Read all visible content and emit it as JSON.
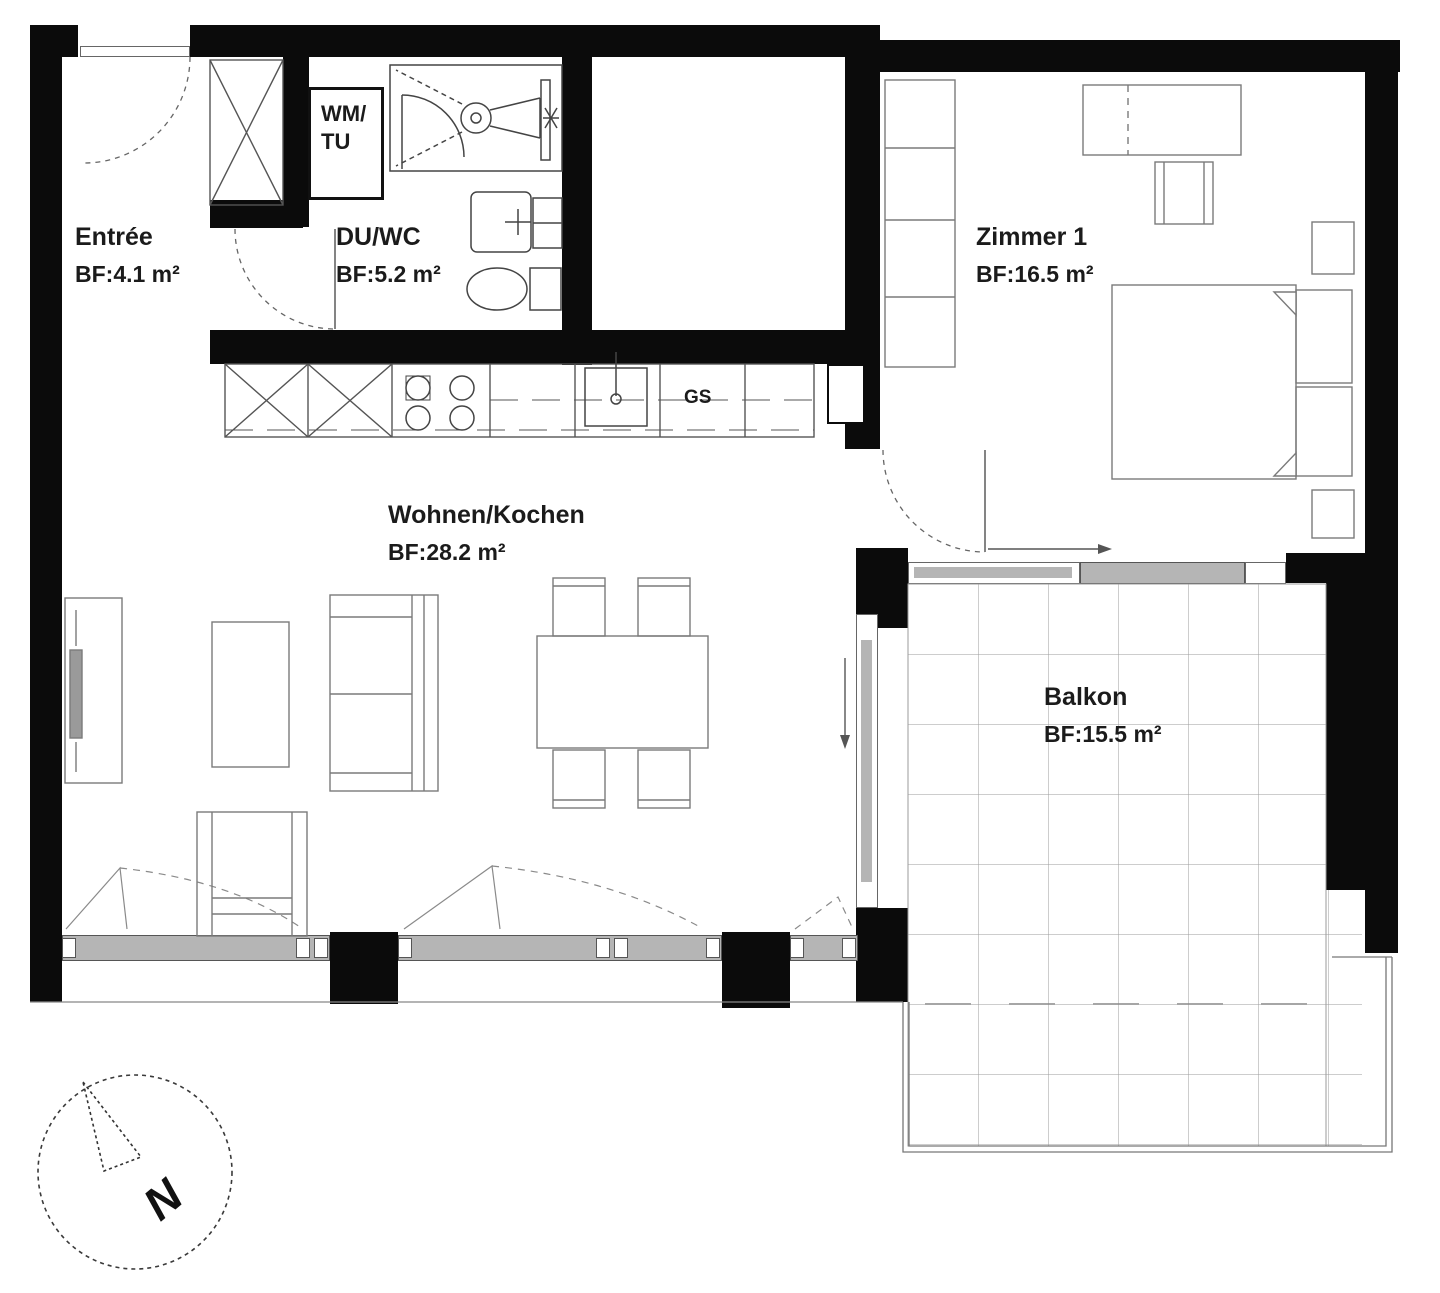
{
  "plan": {
    "rooms": {
      "entree": {
        "name": "Entrée",
        "area": "BF:4.1 m²"
      },
      "du_wc": {
        "name": "DU/WC",
        "area": "BF:5.2 m²"
      },
      "zimmer_1": {
        "name": "Zimmer 1",
        "area": "BF:16.5 m²"
      },
      "wohnen_kochen": {
        "name": "Wohnen/Kochen",
        "area": "BF:28.2 m²"
      },
      "balkon": {
        "name": "Balkon",
        "area": "BF:15.5 m²"
      }
    },
    "appliances": {
      "washer_dryer_line1": "WM/",
      "washer_dryer_line2": "TU",
      "dishwasher": "GS"
    },
    "compass": {
      "north": "N"
    },
    "colors": {
      "wall": "#0b0b0b",
      "glass": "#b5b5b5",
      "furniture_line": "#7a7a7a",
      "fixture_line": "#444444",
      "tile_grid": "#9b9b9b",
      "text": "#1b1b1b",
      "background": "#ffffff"
    }
  }
}
